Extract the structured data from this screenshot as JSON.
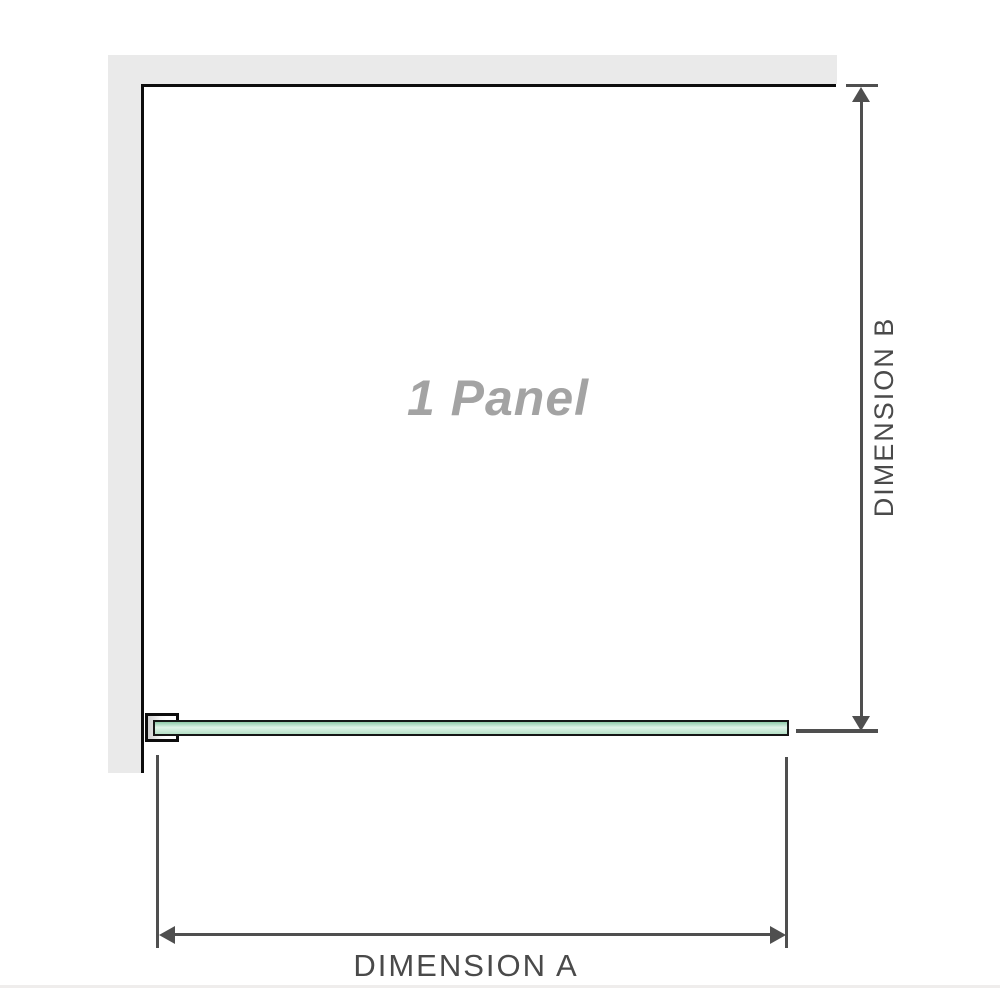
{
  "diagram": {
    "panel_label": "1 Panel",
    "dimension_a_label": "DIMENSION A",
    "dimension_b_label": "DIMENSION B"
  },
  "colors": {
    "background": "#ffffff",
    "wall_fill": "#eaeaea",
    "panel_outline": "#0d0d0d",
    "dimension_line": "#4f4f4f",
    "dimension_text": "#4a4a4a",
    "panel_label_text": "#a3a3a3",
    "glass_border": "#161616",
    "glass_green_top": "#8fcaa8",
    "glass_green_light": "#e0f3e8",
    "glass_green_bottom": "#b5e0c6",
    "bracket_shade": "#d0d0d0",
    "divider": "#efedec"
  }
}
